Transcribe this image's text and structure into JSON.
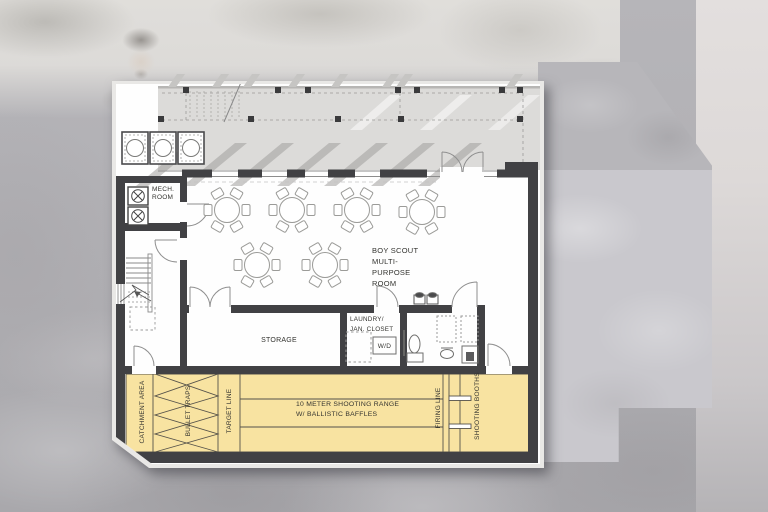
{
  "meta": {
    "description": "Architectural floor plan with Boy Scout multi-purpose room and 10 meter shooting range"
  },
  "labels": {
    "mech_room": [
      "MECH.",
      "ROOM"
    ],
    "multipurpose_room": [
      "BOY SCOUT",
      "MULTI-",
      "PURPOSE",
      "ROOM"
    ],
    "storage": "STORAGE",
    "laundry": [
      "LAUNDRY/",
      "JAN. CLOSET"
    ],
    "washer_dryer": "W/D",
    "range": [
      "10 METER SHOOTING RANGE",
      "W/ BALLISTIC BAFFLES"
    ],
    "catchment_area": "CATCHMENT AREA",
    "bullet_traps": "BULLET TRAPS",
    "target_line": "TARGET LINE",
    "firing_line": "FIRING LINE",
    "shooting_booths": "SHOOTING BOOTHS"
  },
  "colors": {
    "wall": "#414144",
    "range_fill": "#f8e3a1",
    "deck": "#dcdbd9",
    "background": "#b2b1b5",
    "paper": "#fefefe"
  }
}
